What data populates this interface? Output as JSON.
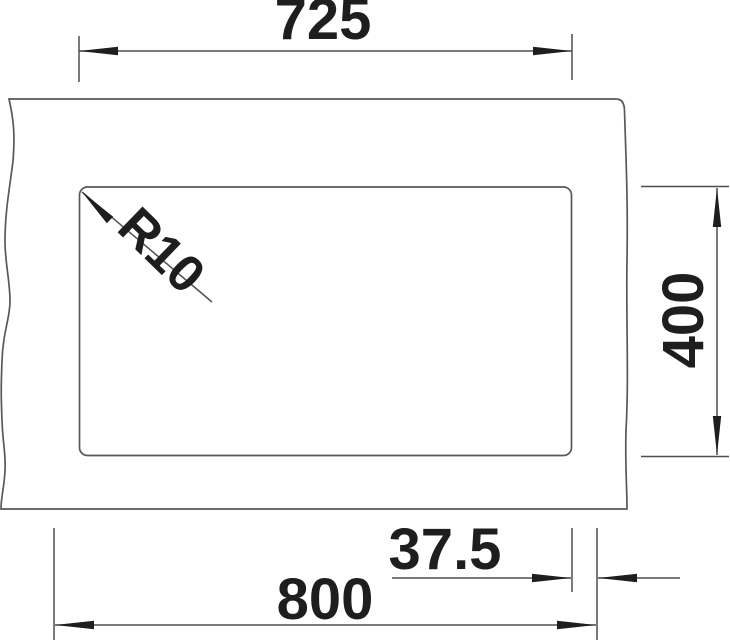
{
  "drawing": {
    "type": "technical-drawing",
    "subject": "undermount sink bowl cutout dimension drawing",
    "dimensions": {
      "width": {
        "label": "725",
        "orientation": "horizontal",
        "location": "top"
      },
      "depth": {
        "label": "400",
        "orientation": "vertical",
        "location": "right"
      },
      "side_offset": {
        "label": "37.5",
        "orientation": "horizontal",
        "location": "bottom"
      },
      "cabinet_width": {
        "label": "800",
        "orientation": "horizontal",
        "location": "bottom"
      },
      "corner_radius": {
        "label": "R10",
        "orientation": "diagonal",
        "location": "top-left-corner"
      }
    },
    "colors": {
      "background": "#ffffff",
      "line": "#58585a",
      "text": "#1e1e1e"
    }
  }
}
